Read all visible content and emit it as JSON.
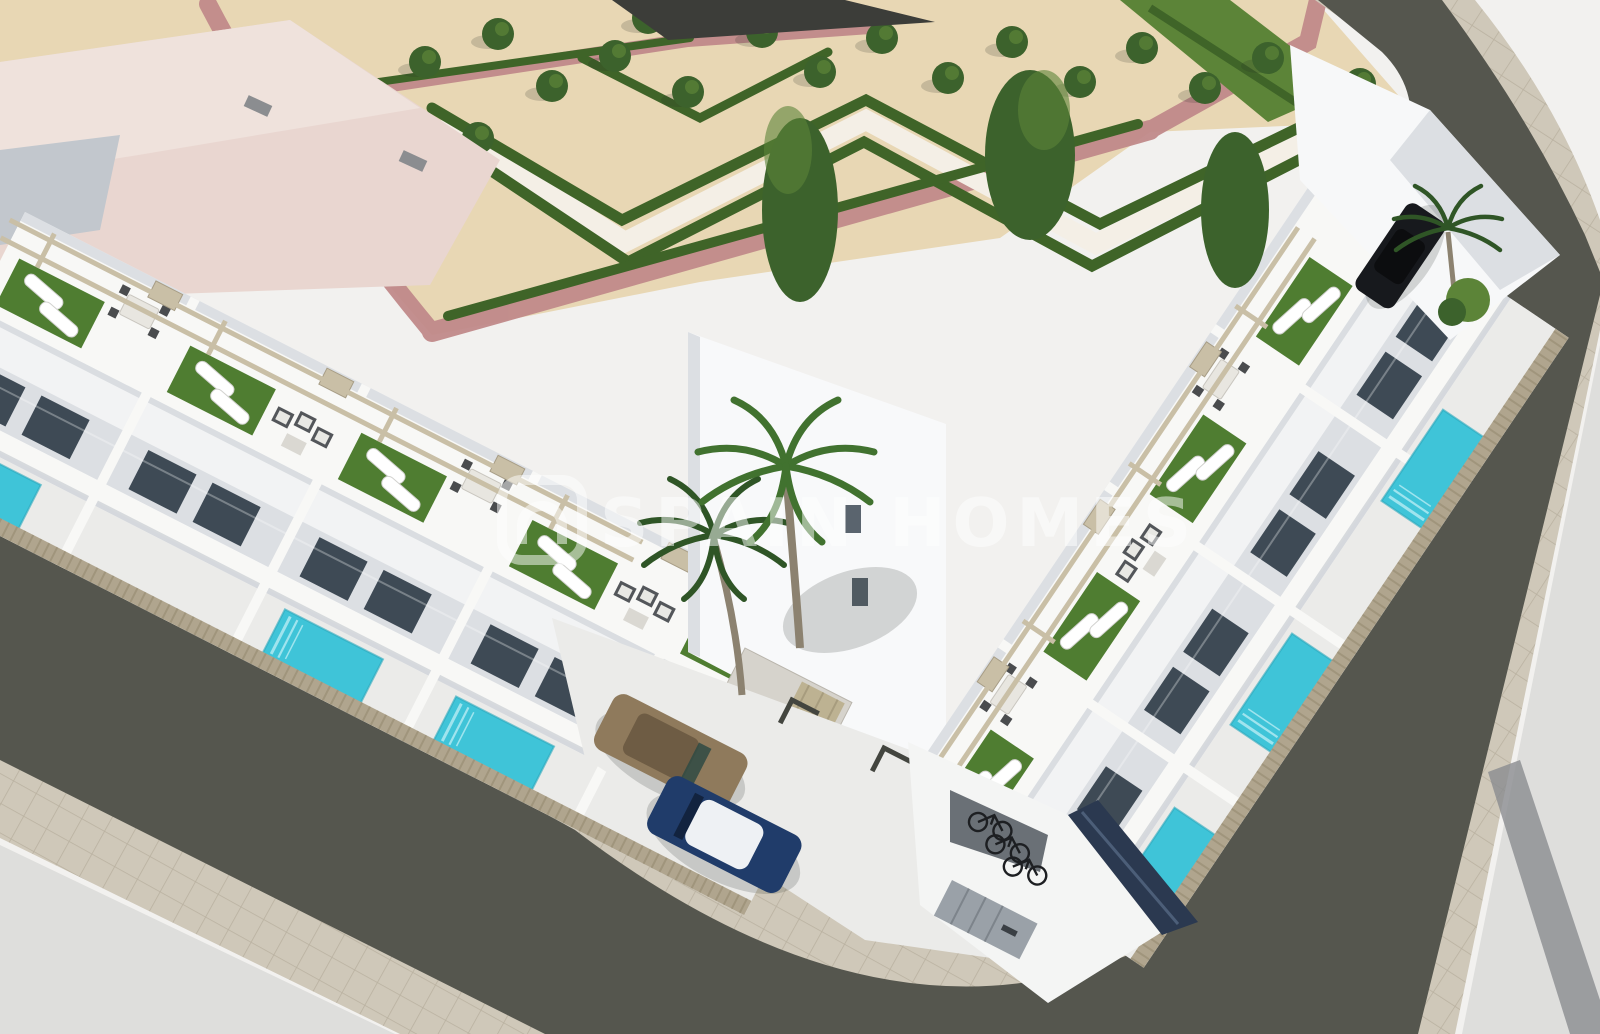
{
  "meta": {
    "title": "Aerial 3D architectural render of a modern white residential corner block",
    "width_px": 1600,
    "height_px": 1034
  },
  "watermark": {
    "text": "SPAIN HOMES",
    "logo": "spainhomes-logo",
    "opacity": "0.5"
  },
  "scene": {
    "setting": "new-build townhouse complex on a street corner, seen from above",
    "park": {
      "ground": "sand",
      "hedges": "geometric double chevron rows with white walkways",
      "paths": "rose pink walkways",
      "tree_count": 21
    },
    "residential_block": {
      "wings": 2,
      "visible_units": 9,
      "roof_terraces": "artificial turf, white sun loungers, dining sets, wicker sofas, pergola beams",
      "private_plunge_pools": 6,
      "pool_color": "turquoise"
    },
    "parking": {
      "courtyard_cars": [
        "bronze car",
        "dark blue car with white roof"
      ],
      "street_car": "black car",
      "bicycles": 3,
      "marked_bays": 3
    },
    "streets": 2,
    "palm_trees": 3,
    "existing_building": "large neighbouring building with pale pink flat roof (top left)"
  },
  "colors": {
    "base": "#f2f1ef",
    "sand": "#e8d7b4",
    "park_path_pink": "#c18a8a",
    "walk_white": "#f4efe6",
    "hedge": "#3f6428",
    "tree": "#3c622c",
    "tree_light": "#5c8438",
    "turf": "#4f7d31",
    "building_top": "#f8f8f6",
    "building_white": "#f2f3f4",
    "building_shade": "#dcdfe3",
    "building_dark": "#c2c7cd",
    "glass": "#3e4a55",
    "pool": "#3fc4d8",
    "pool_light": "#9fe4ee",
    "asphalt": "#55564e",
    "sidewalk": "#cfc8b9",
    "sidewalk_line": "#b9b1a0",
    "plot_light": "#dededc",
    "plot_stripe": "#8a8c90",
    "fence": "#b0a58e",
    "fence_slat": "#8d8268",
    "pergola": "#c9bfa6",
    "car_bronze": "#8f7a5c",
    "car_bronze_dark": "#6e5c44",
    "car_blue": "#203c6a",
    "car_roof": "#eef1f4",
    "car_dark": "#17191d",
    "bike": "#1d1f22",
    "roof_pink": "#e9d6d0",
    "roof_pink_light": "#efe2dc",
    "dark_band": "#3c3d39",
    "concrete": "#ebebe9",
    "shadow": "rgba(40,42,38,0.18)",
    "watermark": "#ffffff"
  }
}
